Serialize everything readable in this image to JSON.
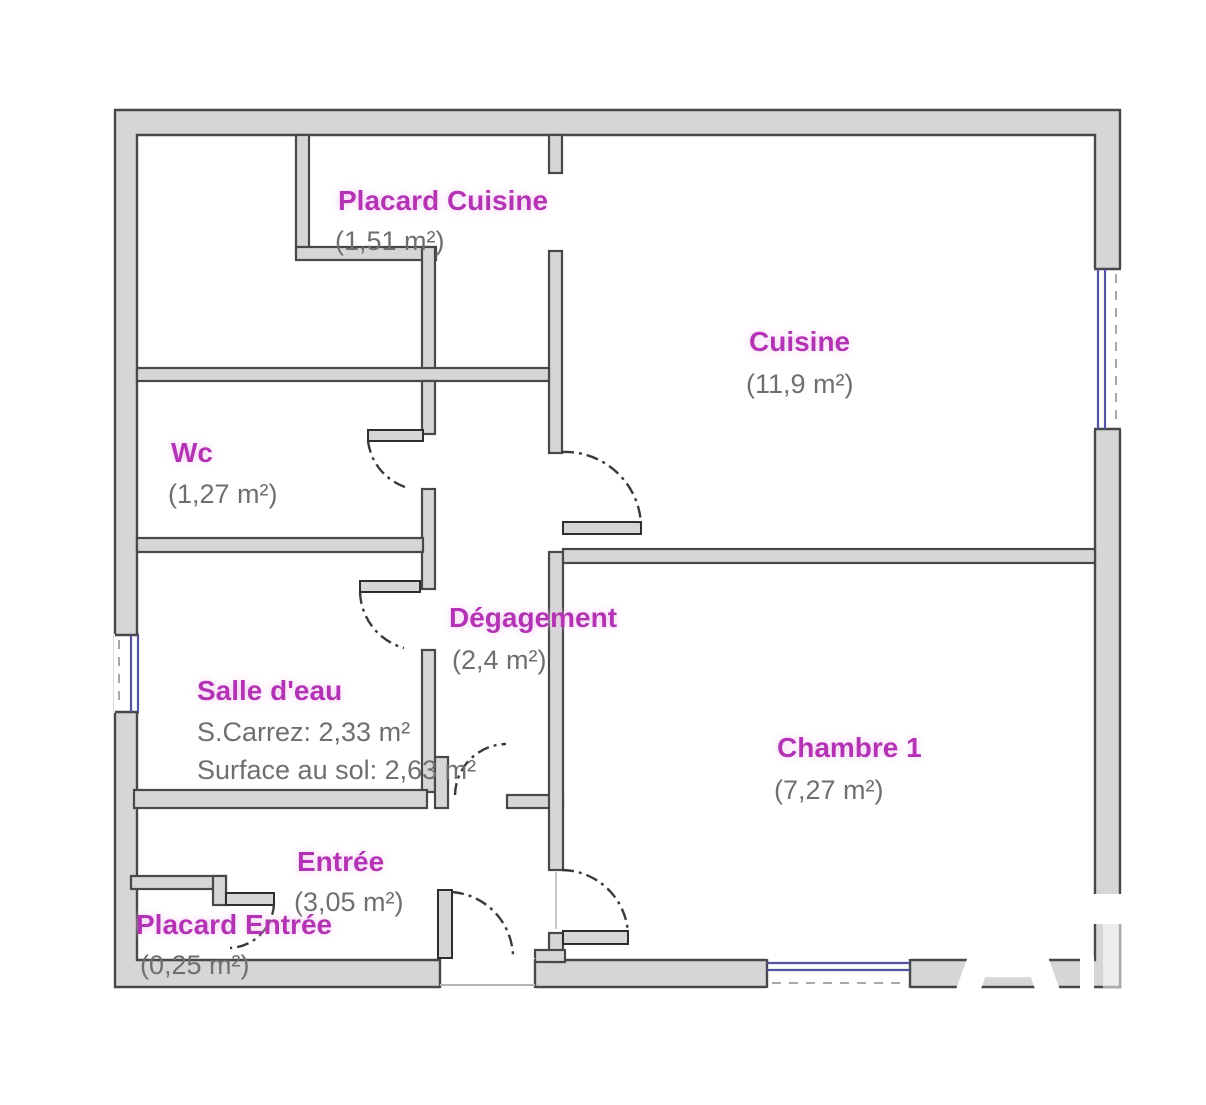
{
  "floorplan": {
    "title": "Plan d'appartement",
    "rooms": [
      {
        "id": "placard-cuisine",
        "name": "Placard Cuisine",
        "area": "(1,51 m²)"
      },
      {
        "id": "cuisine",
        "name": "Cuisine",
        "area": "(11,9 m²)"
      },
      {
        "id": "wc",
        "name": "Wc",
        "area": "(1,27 m²)"
      },
      {
        "id": "degagement",
        "name": "Dégagement",
        "area": "(2,4 m²)"
      },
      {
        "id": "salle-eau",
        "name": "Salle d'eau",
        "area_carrez": "S.Carrez: 2,33 m²",
        "area_floor": "Surface au sol: 2,63 m²"
      },
      {
        "id": "chambre-1",
        "name": "Chambre 1",
        "area": "(7,27 m²)"
      },
      {
        "id": "entree",
        "name": "Entrée",
        "area": "(3,05 m²)"
      },
      {
        "id": "placard-entree",
        "name": "Placard Entrée",
        "area": "(0,25 m²)"
      }
    ],
    "watermark": "A",
    "colors": {
      "room_label": "#b431b4",
      "area_text": "#6f6f6f",
      "wall_fill": "#d6d6d6",
      "wall_edge": "#484848",
      "window_blue": "#5353a4"
    }
  }
}
